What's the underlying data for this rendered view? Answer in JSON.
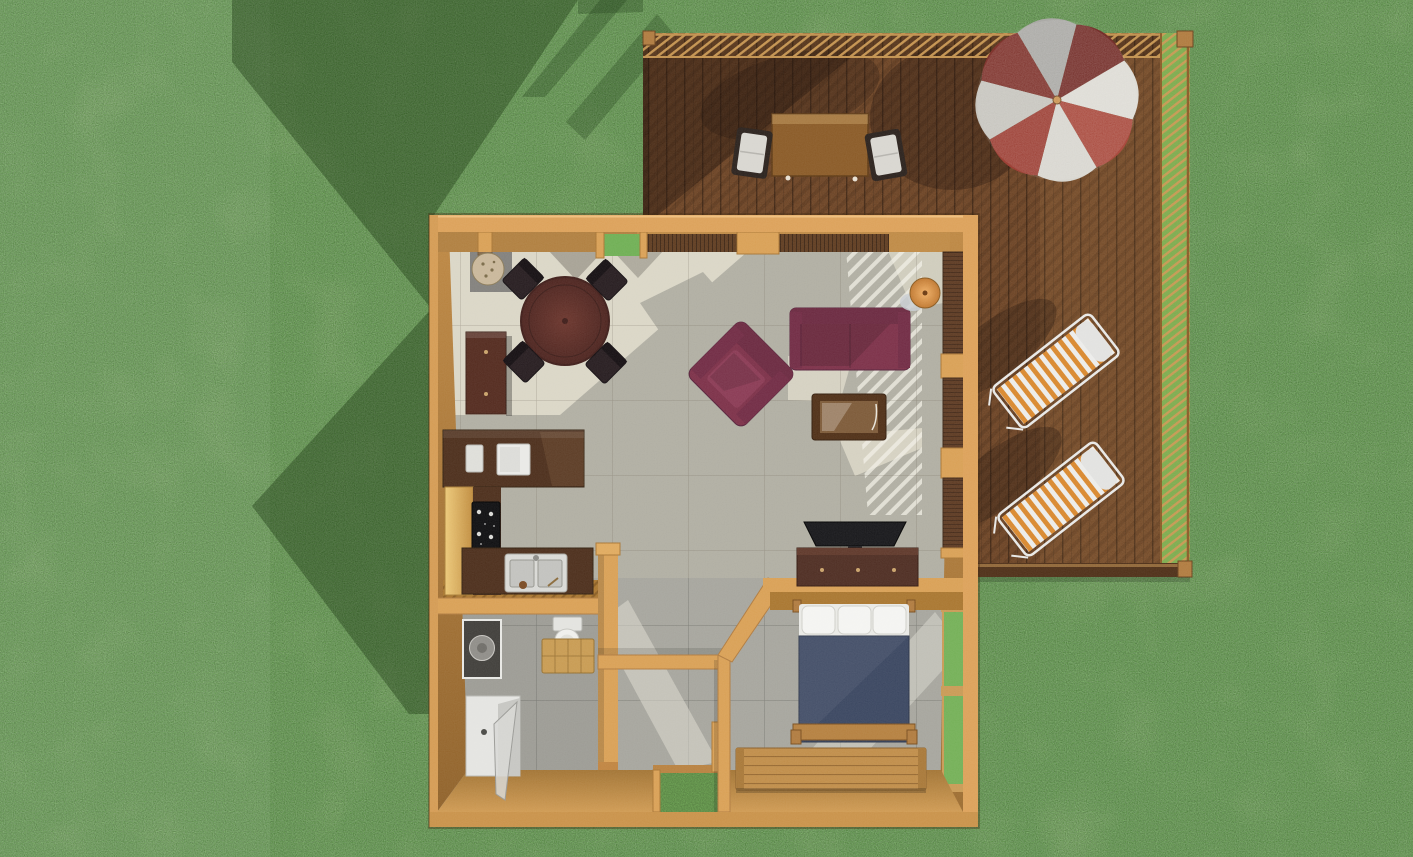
{
  "scene": {
    "title": "Top-down 3D rendered floor plan of a small cabin with wooden deck",
    "view": "top-down perspective render",
    "rooms": [
      "living-dining room",
      "kitchen",
      "bathroom",
      "entry hall",
      "bedroom",
      "deck"
    ]
  },
  "palette": {
    "grass": "#74B057",
    "grass_shadow": "#3E6B2F",
    "deck_wood": "#7A4C29",
    "deck_rail_tan": "#C2914E",
    "wall_tan": "#D9A055",
    "wall_face": "#B8823F",
    "floor_lit": "#DAD6C6",
    "floor_shadow": "#B0AEA2",
    "tile_gray": "#A6A59D",
    "sofa_burgundy": "#7C3048",
    "dining_table_wood": "#5E2C27",
    "counter_dark": "#4C2E1B",
    "cabinet_tan": "#E2BC6A",
    "stove_black": "#0E0E10",
    "bed_blanket_blue": "#3A4660",
    "pillow_white": "#F4F4F1",
    "bench_wood": "#C08D49",
    "umbrella_red": "#9C3B30",
    "umbrella_white": "#D6D4CD",
    "lounger_orange": "#D9882E",
    "fixture_white": "#E9E9E6",
    "lamp_orange": "#D89248",
    "tv_black": "#17171A"
  },
  "objects": {
    "deck": "wooden deck",
    "deck_railing": "deck lattice railing",
    "umbrella": "red and white patio umbrella",
    "outdoor_table": "outdoor dining table",
    "outdoor_chair": "outdoor dining chair",
    "lounger": "orange striped sun lounger",
    "sofa": "burgundy sofa",
    "armchair": "burgundy armchair",
    "coffee_table": "coffee table",
    "floor_lamp": "orange floor lamp",
    "tv": "flat TV",
    "dresser": "media dresser",
    "dining_table": "round dining table",
    "dining_chair": "dining chair",
    "plant": "potted plant",
    "buffet": "buffet cabinet",
    "counter": "kitchen counter",
    "appliance": "countertop appliance",
    "stove": "black cooktop",
    "sink": "double kitchen sink",
    "vanity": "bathroom vanity sink",
    "toilet": "toilet",
    "side_table": "wooden side table",
    "shower": "shower stall",
    "bed": "bed with blue blanket and white pillows",
    "bench": "wooden storage bench",
    "patio_doors": "folding patio doors",
    "bedroom_window": "bedroom window",
    "front_door": "entry door opening",
    "top_windows": "front wall windows"
  }
}
